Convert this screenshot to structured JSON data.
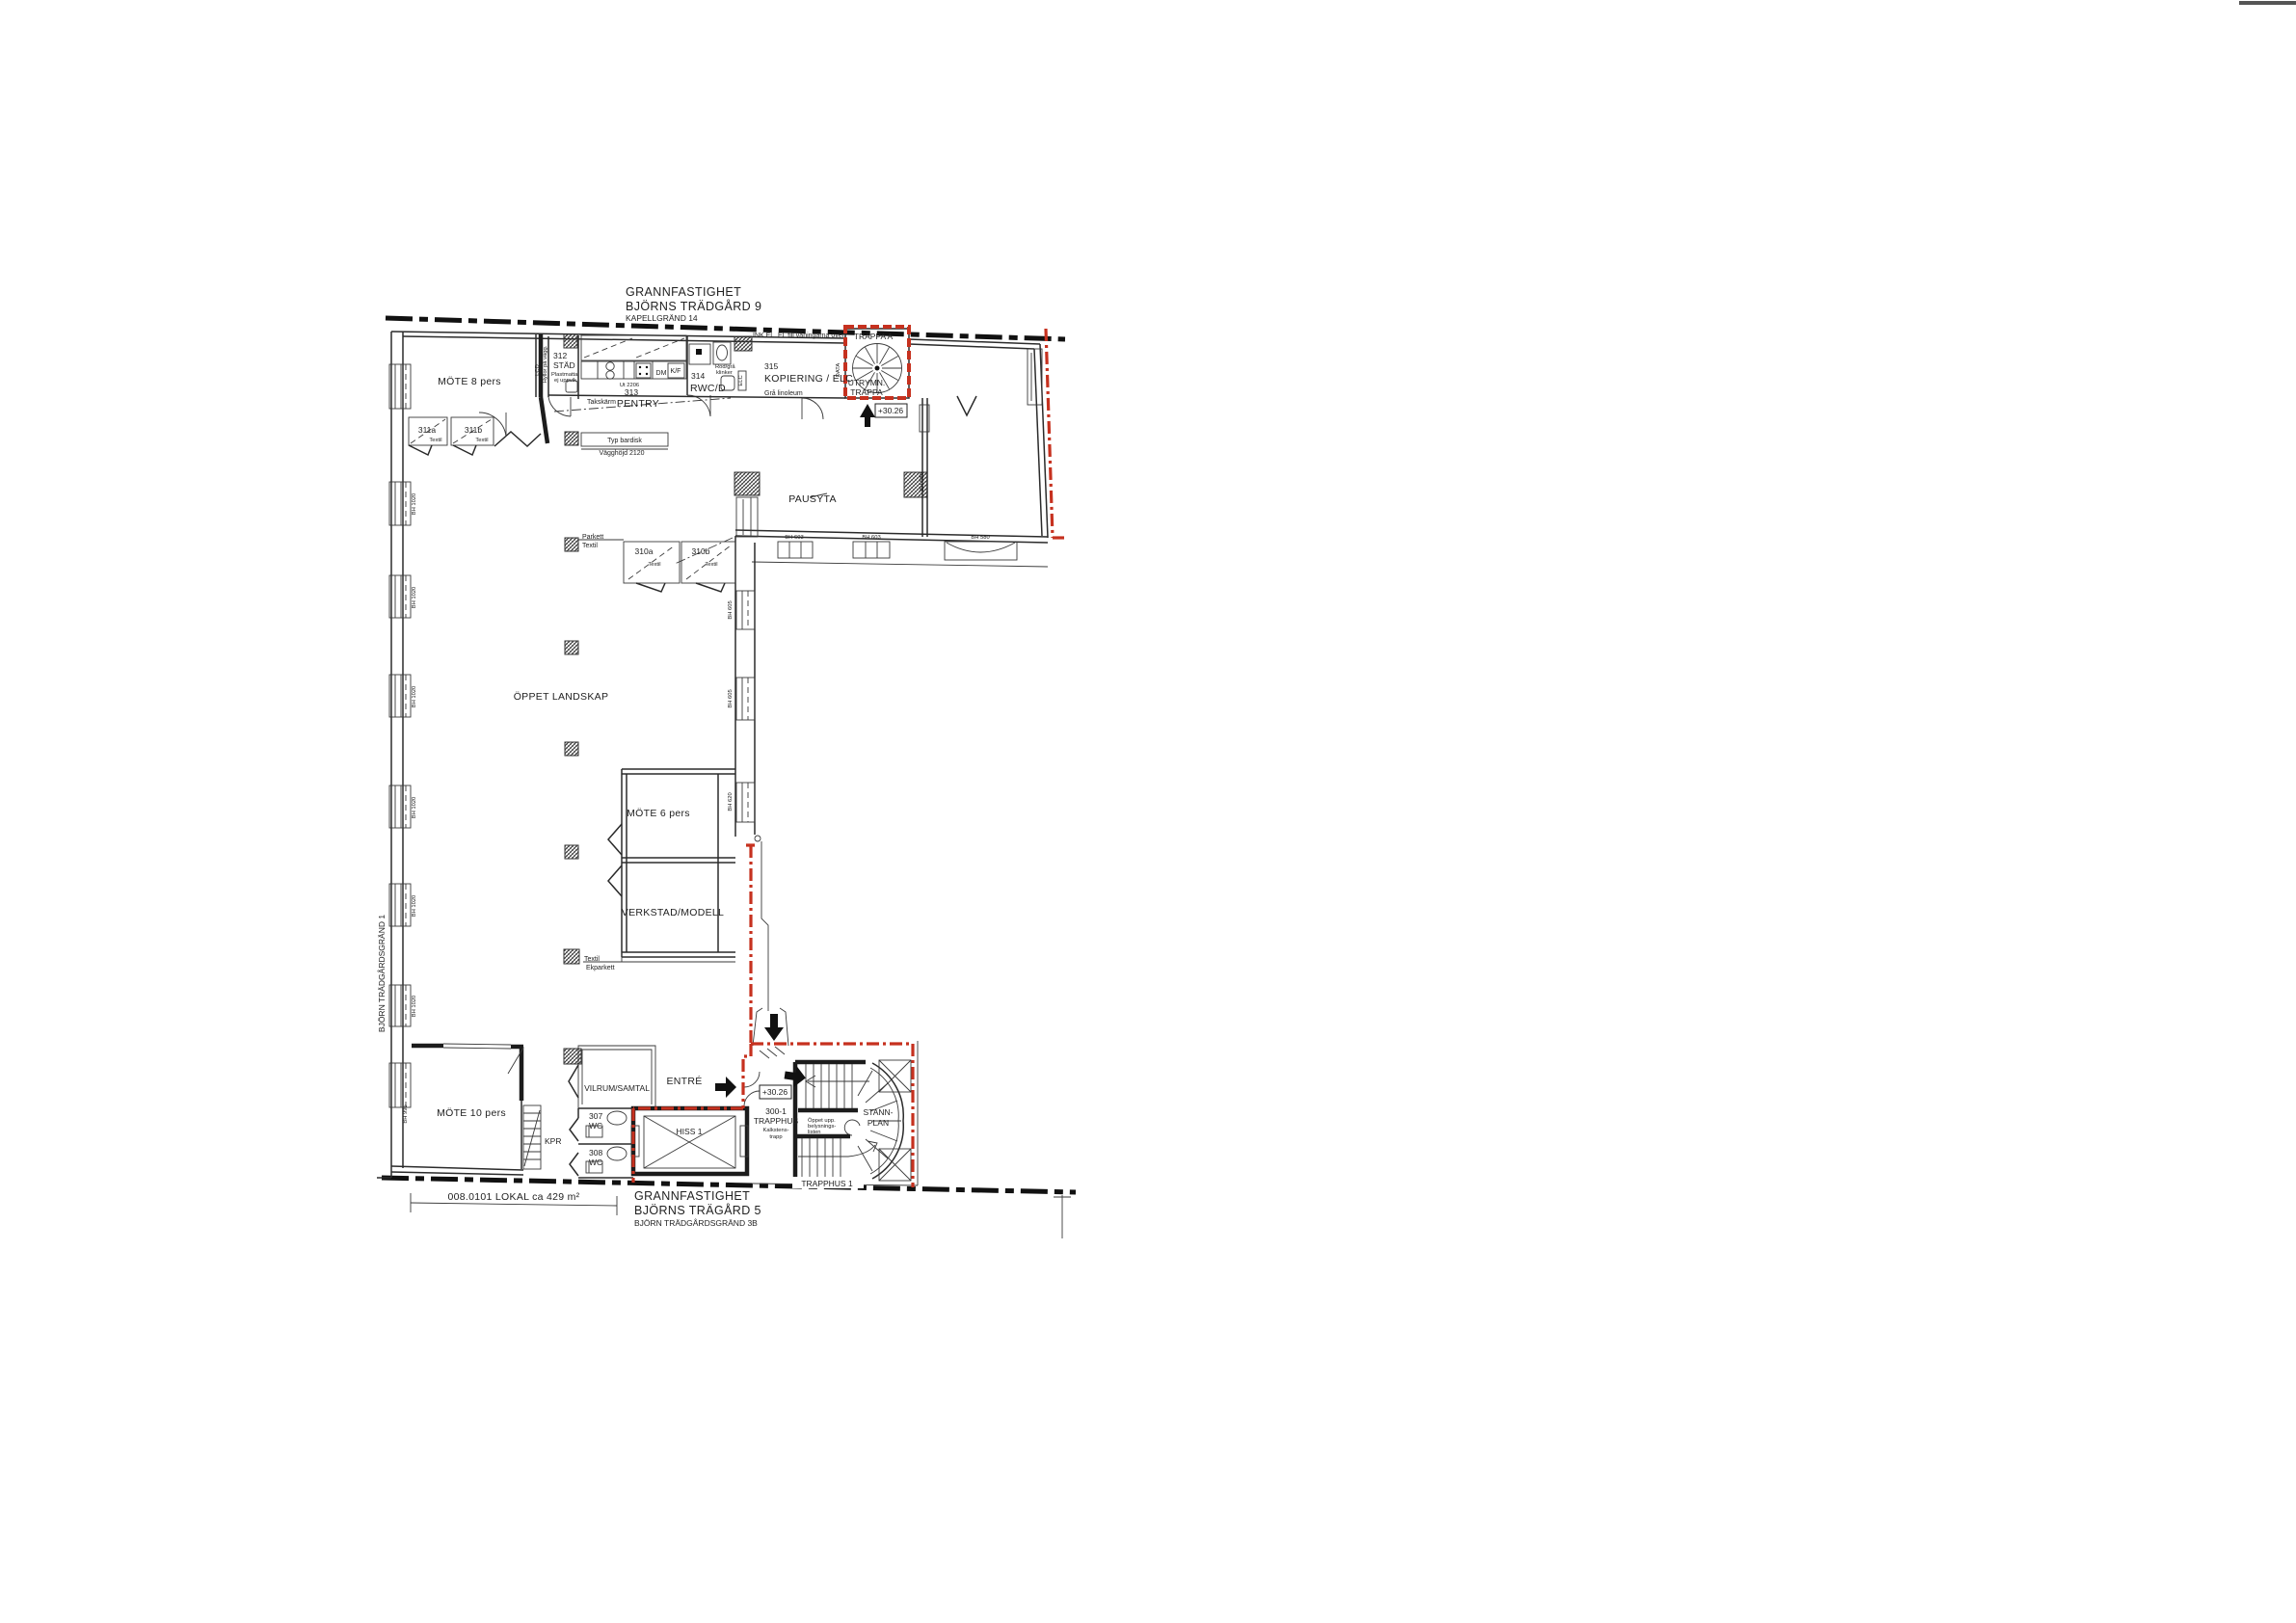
{
  "colors": {
    "accent_red": "#c6311f",
    "ink": "#222222",
    "background": "#ffffff"
  },
  "titles": {
    "top1": "GRANNFASTIGHET",
    "top2": "BJÖRNS TRÄDGÅRD 9",
    "top3": "KAPELLGRÄND 14",
    "bottom1": "GRANNFASTIGHET",
    "bottom2": "BJÖRNS TRÄGÅRD 5",
    "bottom3": "BJÖRN TRÄDGÅRDSGRÄND 3B",
    "street_left": "BJÖRN TRÄDGÅRDSGRÄND 1"
  },
  "dimension": {
    "text": "008.0101 LOKAL ca 429 m²"
  },
  "rooms": {
    "mote8": "MÖTE 8 pers",
    "w311a": "311a",
    "w311a_mat": "Textil",
    "w311b": "311b",
    "w311b_mat": "Textil",
    "stad_num": "312",
    "stad": "STÄD",
    "stad_note1": "Plastmatta",
    "stad_note2": "ej uppvik",
    "lcd": "LCD",
    "hyllor": "Hyllor på vägg.",
    "pentry_num": "313",
    "pentry": "PENTRY",
    "takskarm": "Takskärm",
    "ut2206": "Ut 2206",
    "dm": "DM",
    "kf": "K/F",
    "rwc_num": "314",
    "rwc": "RWC/D",
    "klinker1": "Röd/grå",
    "klinker2": "klinker",
    "ink_el": "INK EL",
    "el_till": "EL till våningarna över.",
    "trappa_a": "TRAPPA A",
    "kopiering_num": "315",
    "kopiering": "KOPIERING / ELC",
    "data": "DATA",
    "elc": "ELC",
    "gra_linoleum": "Grå linoleum",
    "utrymn1": "UTRYMN.",
    "utrymn2": "TRAPPA",
    "level_a": "+30.26",
    "pausyta": "PAUSYTA",
    "bardisk": "Typ bardisk",
    "vagghojd": "Vägghöjd 2120",
    "parkett": "Parkett",
    "parkett_mat": "Textil",
    "w310a": "310a",
    "w310a_mat": "Textil",
    "w310b": "310b",
    "w310b_mat": "Textil",
    "oppet": "ÖPPET LANDSKAP",
    "mote6": "MÖTE 6 pers",
    "verkstad": "VERKSTAD/MODELL",
    "ekparkett1": "Textil",
    "ekparkett2": "Ekparkett",
    "mote10": "MÖTE 10 pers",
    "kpr": "KPR",
    "vilrum": "VILRUM/SAMTAL",
    "wc307_num": "307",
    "wc307": "WC",
    "wc308_num": "308",
    "wc308": "WC",
    "entre": "ENTRÉ",
    "hiss": "HISS 1",
    "level_b": "+30.26",
    "trapphus_num": "300-1",
    "trapphus": "TRAPPHUS",
    "kalksten1": "Kalkstens-",
    "kalksten2": "trapp",
    "oppet_upp1": "Öppet upp.",
    "oppet_upp2": "belysnings-",
    "oppet_upp3": "listen",
    "stann1": "STANN-",
    "stann2": "PLAN",
    "trapphus1": "TRAPPHUS 1"
  },
  "bh": {
    "wl1": "BH 1020",
    "wl2": "BH 1020",
    "wl3": "BH 1020",
    "wl4": "BH 1020",
    "wl5": "BH 1020",
    "wl6": "BH 1020",
    "wl7": "BH 995",
    "s1": "BH 603",
    "s2": "BH 603",
    "s3": "BH 580",
    "side": "BH 580",
    "c1": "BH 605",
    "c2": "BH 605",
    "c3": "BH 620"
  }
}
